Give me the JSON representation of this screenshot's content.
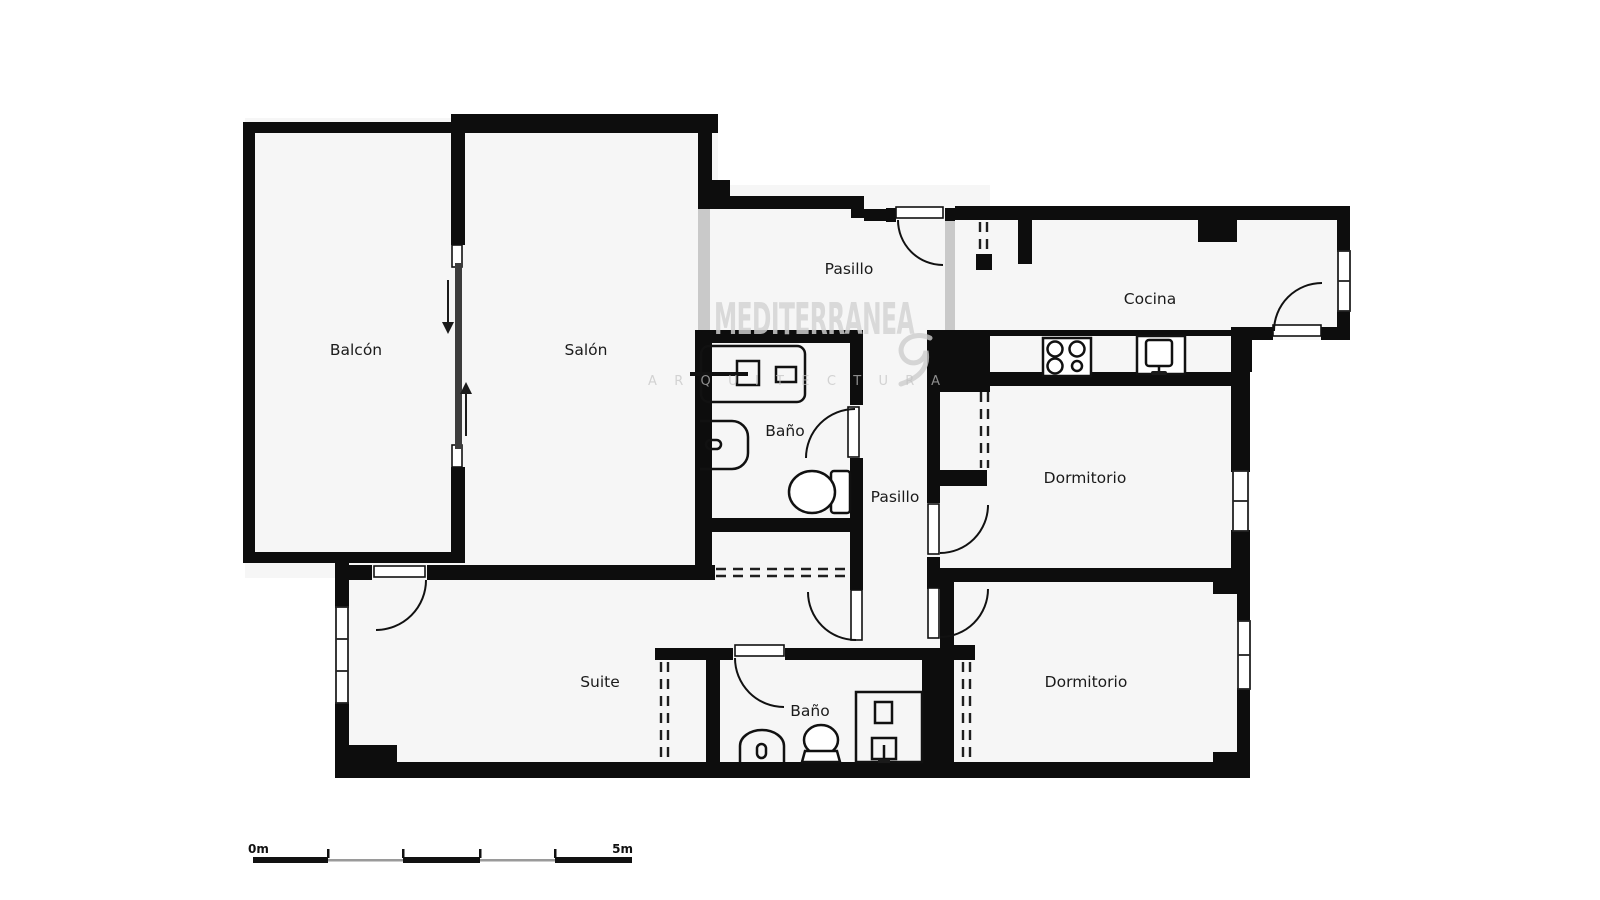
{
  "rooms": {
    "balcon": {
      "label": "Balcón"
    },
    "salon": {
      "label": "Salón"
    },
    "pasillo_top": {
      "label": "Pasillo"
    },
    "cocina": {
      "label": "Cocina"
    },
    "bano_top": {
      "label": "Baño"
    },
    "pasillo_mid": {
      "label": "Pasillo"
    },
    "dormitorio_mid": {
      "label": "Dormitorio"
    },
    "suite": {
      "label": "Suite"
    },
    "bano_bottom": {
      "label": "Baño"
    },
    "dormitorio_bottom": {
      "label": "Dormitorio"
    }
  },
  "watermark": {
    "title": "MEDITERRANEA",
    "subtitle": "ARQUITECTURA"
  },
  "scale_bar": {
    "start_label": "0m",
    "end_label": "5m"
  },
  "colors": {
    "wall": "#0d0d0d",
    "floor": "#f6f6f6",
    "glass": "#c9c9c9",
    "watermark": "#d3d3d3"
  }
}
